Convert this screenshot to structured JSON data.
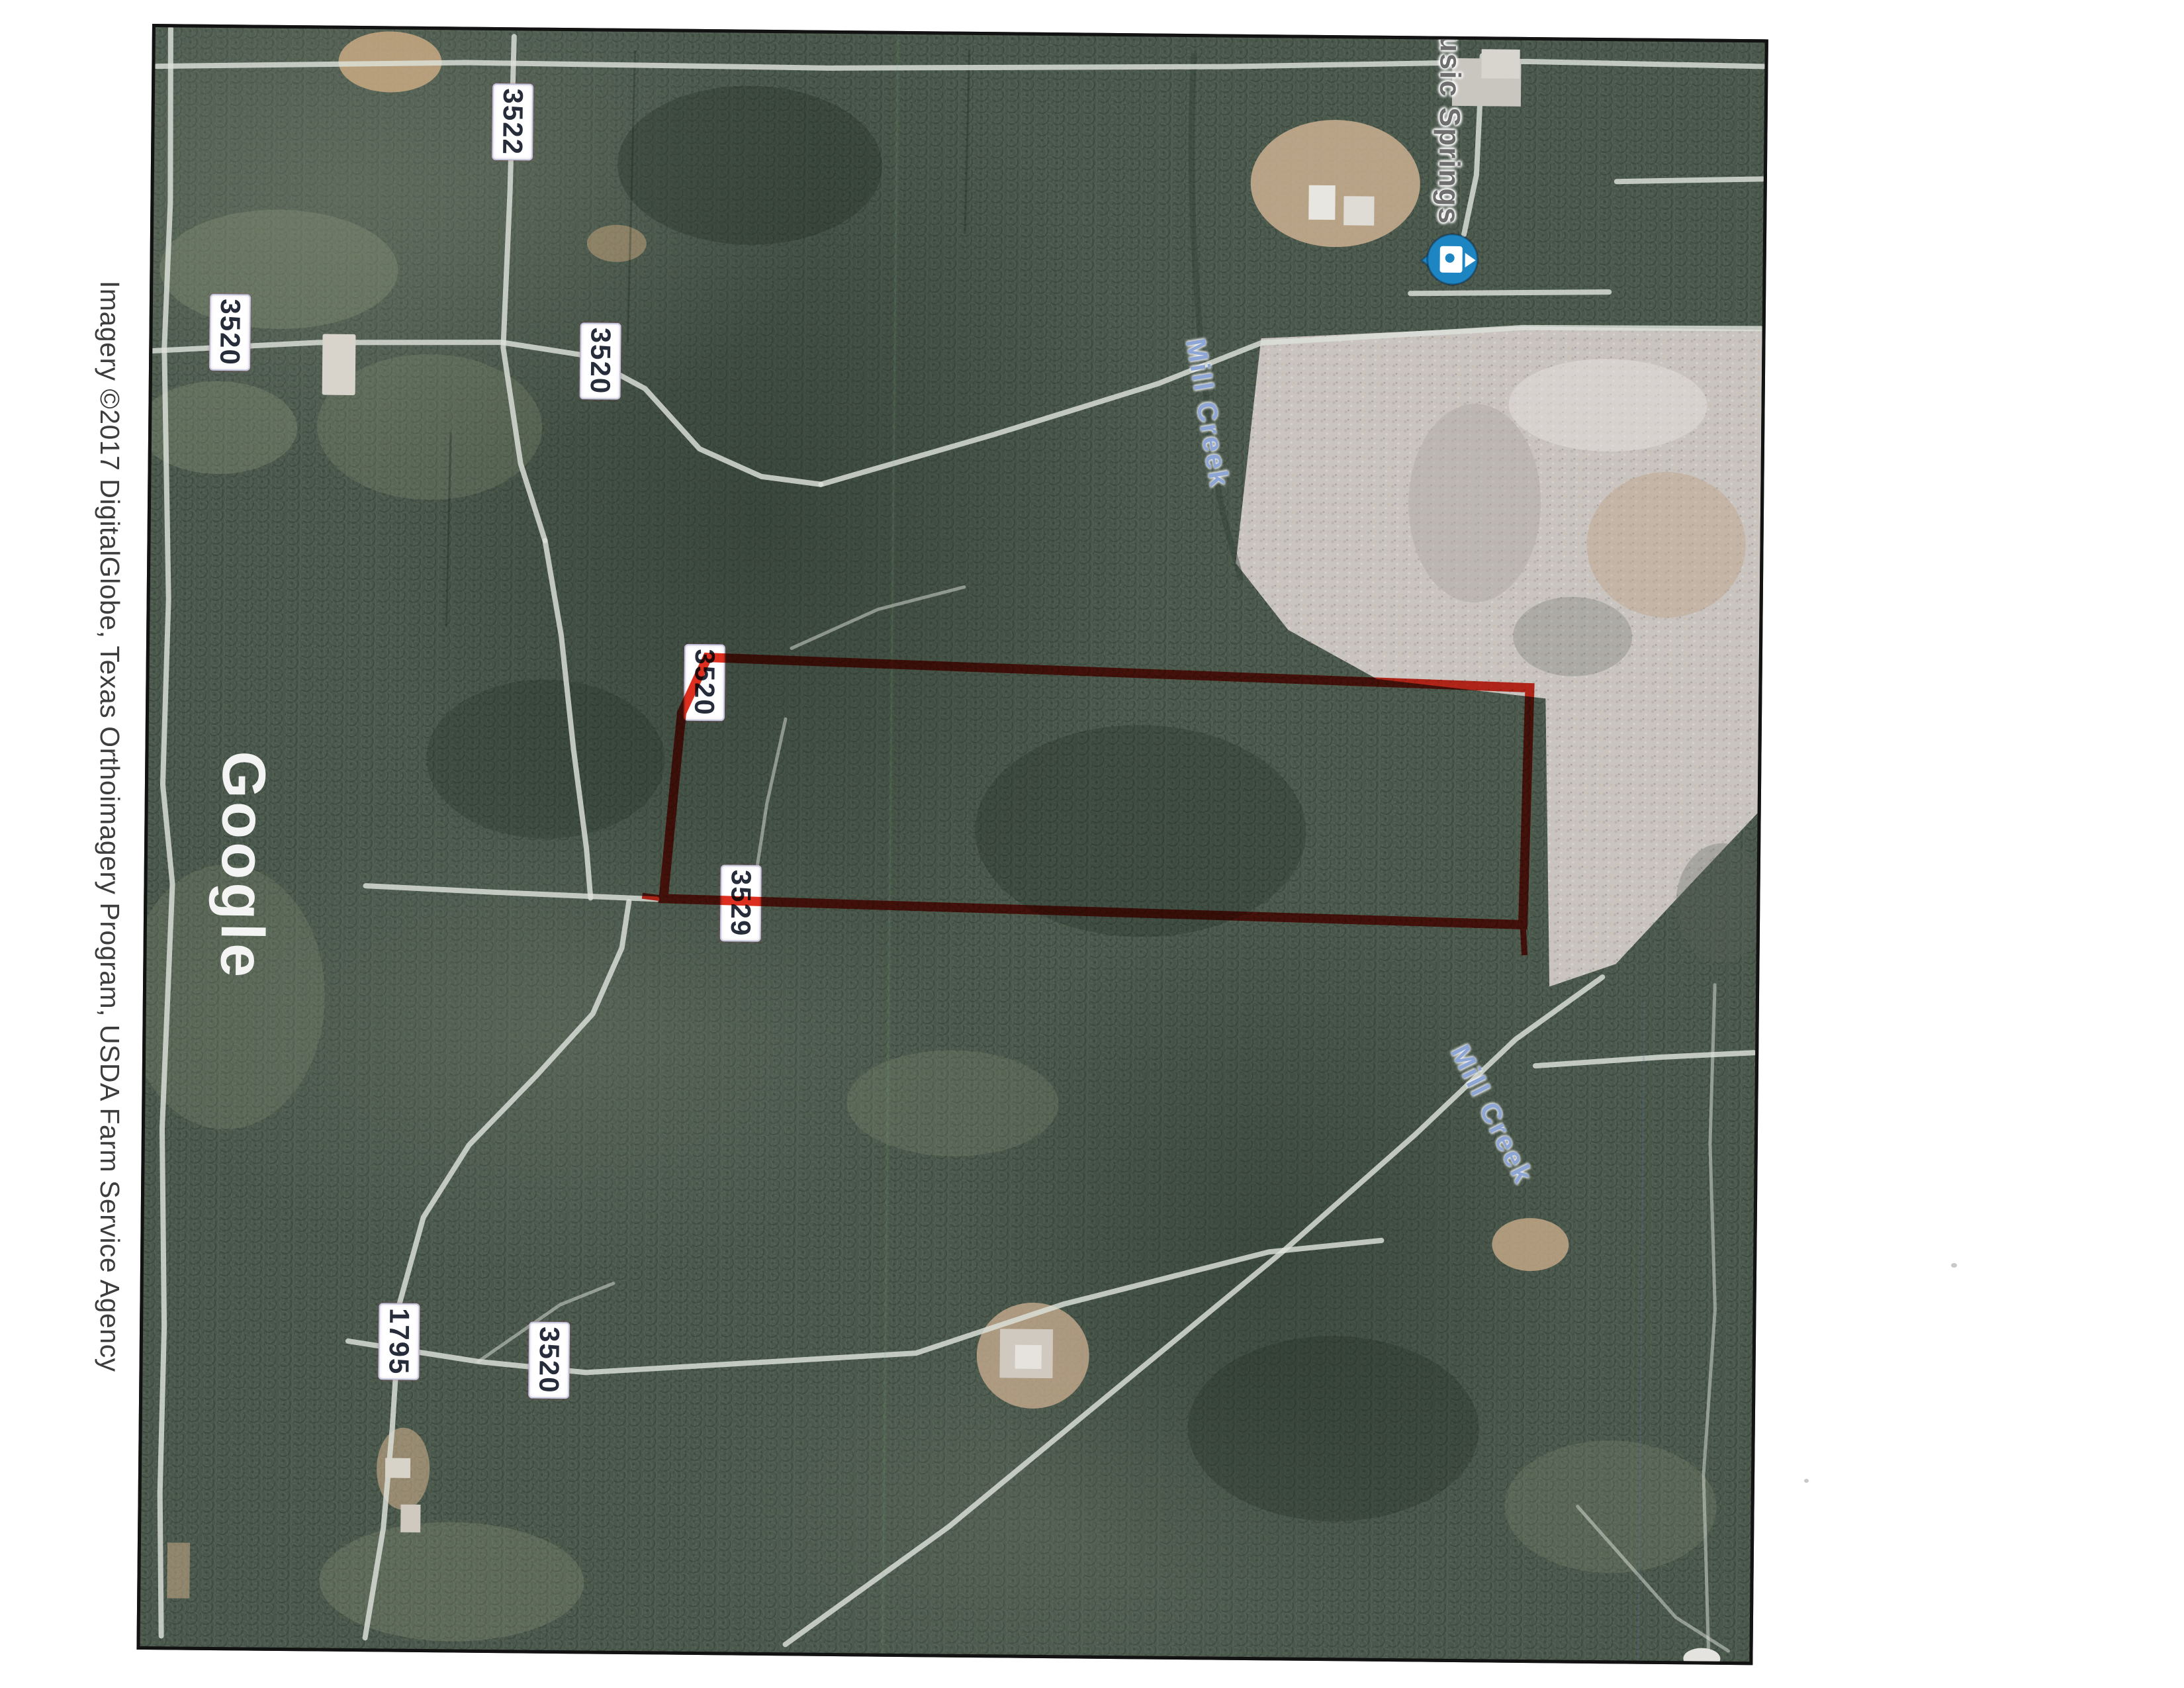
{
  "document": {
    "type": "scanned satellite map printout",
    "attribution": "Imagery ©2017 DigitalGlobe, Texas Orthoimagery Program, USDA Farm Service Agency",
    "watermark": "Google"
  },
  "map": {
    "poi_label": "usic Springs",
    "creek_label_1": "Mill Creek",
    "creek_label_2": "Mill Creek",
    "road_labels": [
      "3522",
      "3520",
      "3520",
      "3520",
      "3529",
      "1795",
      "3520"
    ],
    "boundary": {
      "description": "red property outline",
      "color": "#dd2f1f"
    },
    "colors": {
      "forest": "#4a584c",
      "clearing": "#c9c4c0",
      "road": "#dde2da",
      "water_text": "#8ea6d6",
      "poi_marker": "#1d86c2",
      "shield_text": "#262c3a",
      "attribution_text": "#3d3d3d"
    }
  }
}
